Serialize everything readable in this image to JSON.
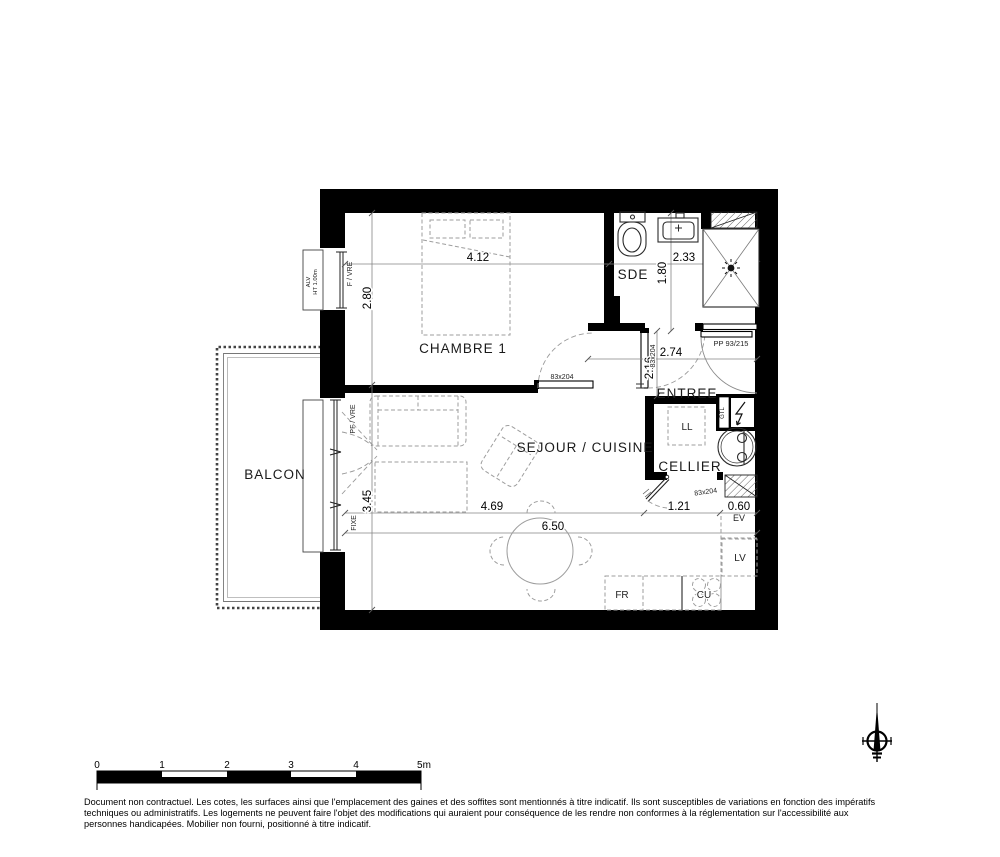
{
  "rooms": {
    "chambre": "CHAMBRE 1",
    "sde": "SDE",
    "entree": "ENTREE",
    "sejour_cuisine": "SEJOUR / CUISINE",
    "cellier": "CELLIER",
    "balcon": "BALCON"
  },
  "dimensions": {
    "chambre_width": "4.12",
    "chambre_depth": "2.80",
    "sde_width": "2.33",
    "sde_depth": "1.80",
    "entree_width": "2.74",
    "entree_depth": "2.16",
    "sejour_depth": "3.45",
    "sejour_width": "4.69",
    "total_width": "6.50",
    "cellier_width": "1.21",
    "kitchen_depth": "0.60"
  },
  "doors": {
    "chambre_door": "83x204",
    "sde_door": "83x204",
    "cellier_door": "83x204",
    "entry_door": "PP 93/215"
  },
  "windows": {
    "chambre_window": "F / VRE",
    "chambre_sill": "ALV",
    "chambre_sill_height": "HT 1.00m",
    "sejour_window": "PF / VRE",
    "sejour_window_fixed": "FIXE"
  },
  "equipment": {
    "washing_machine": "LL",
    "technical_duct": "GTL",
    "sink": "EV",
    "dishwasher": "LV",
    "fridge": "FR",
    "hob": "CU"
  },
  "scale_bar": {
    "ticks": [
      "0",
      "1",
      "2",
      "3",
      "4",
      "5m"
    ]
  },
  "footer": {
    "line1": "Document non contractuel. Les cotes, les surfaces ainsi que l'emplacement des gaines et des soffites sont mentionnés à titre indicatif. Ils sont susceptibles de variations en fonction des impératifs",
    "line2": "techniques ou administratifs. Les logements ne peuvent faire l'objet des modifications qui auraient pour conséquence de les rendre non conformes à la réglementation sur l'accessibilité aux",
    "line3": "personnes handicapées. Mobilier non fourni, positionné à titre indicatif."
  }
}
